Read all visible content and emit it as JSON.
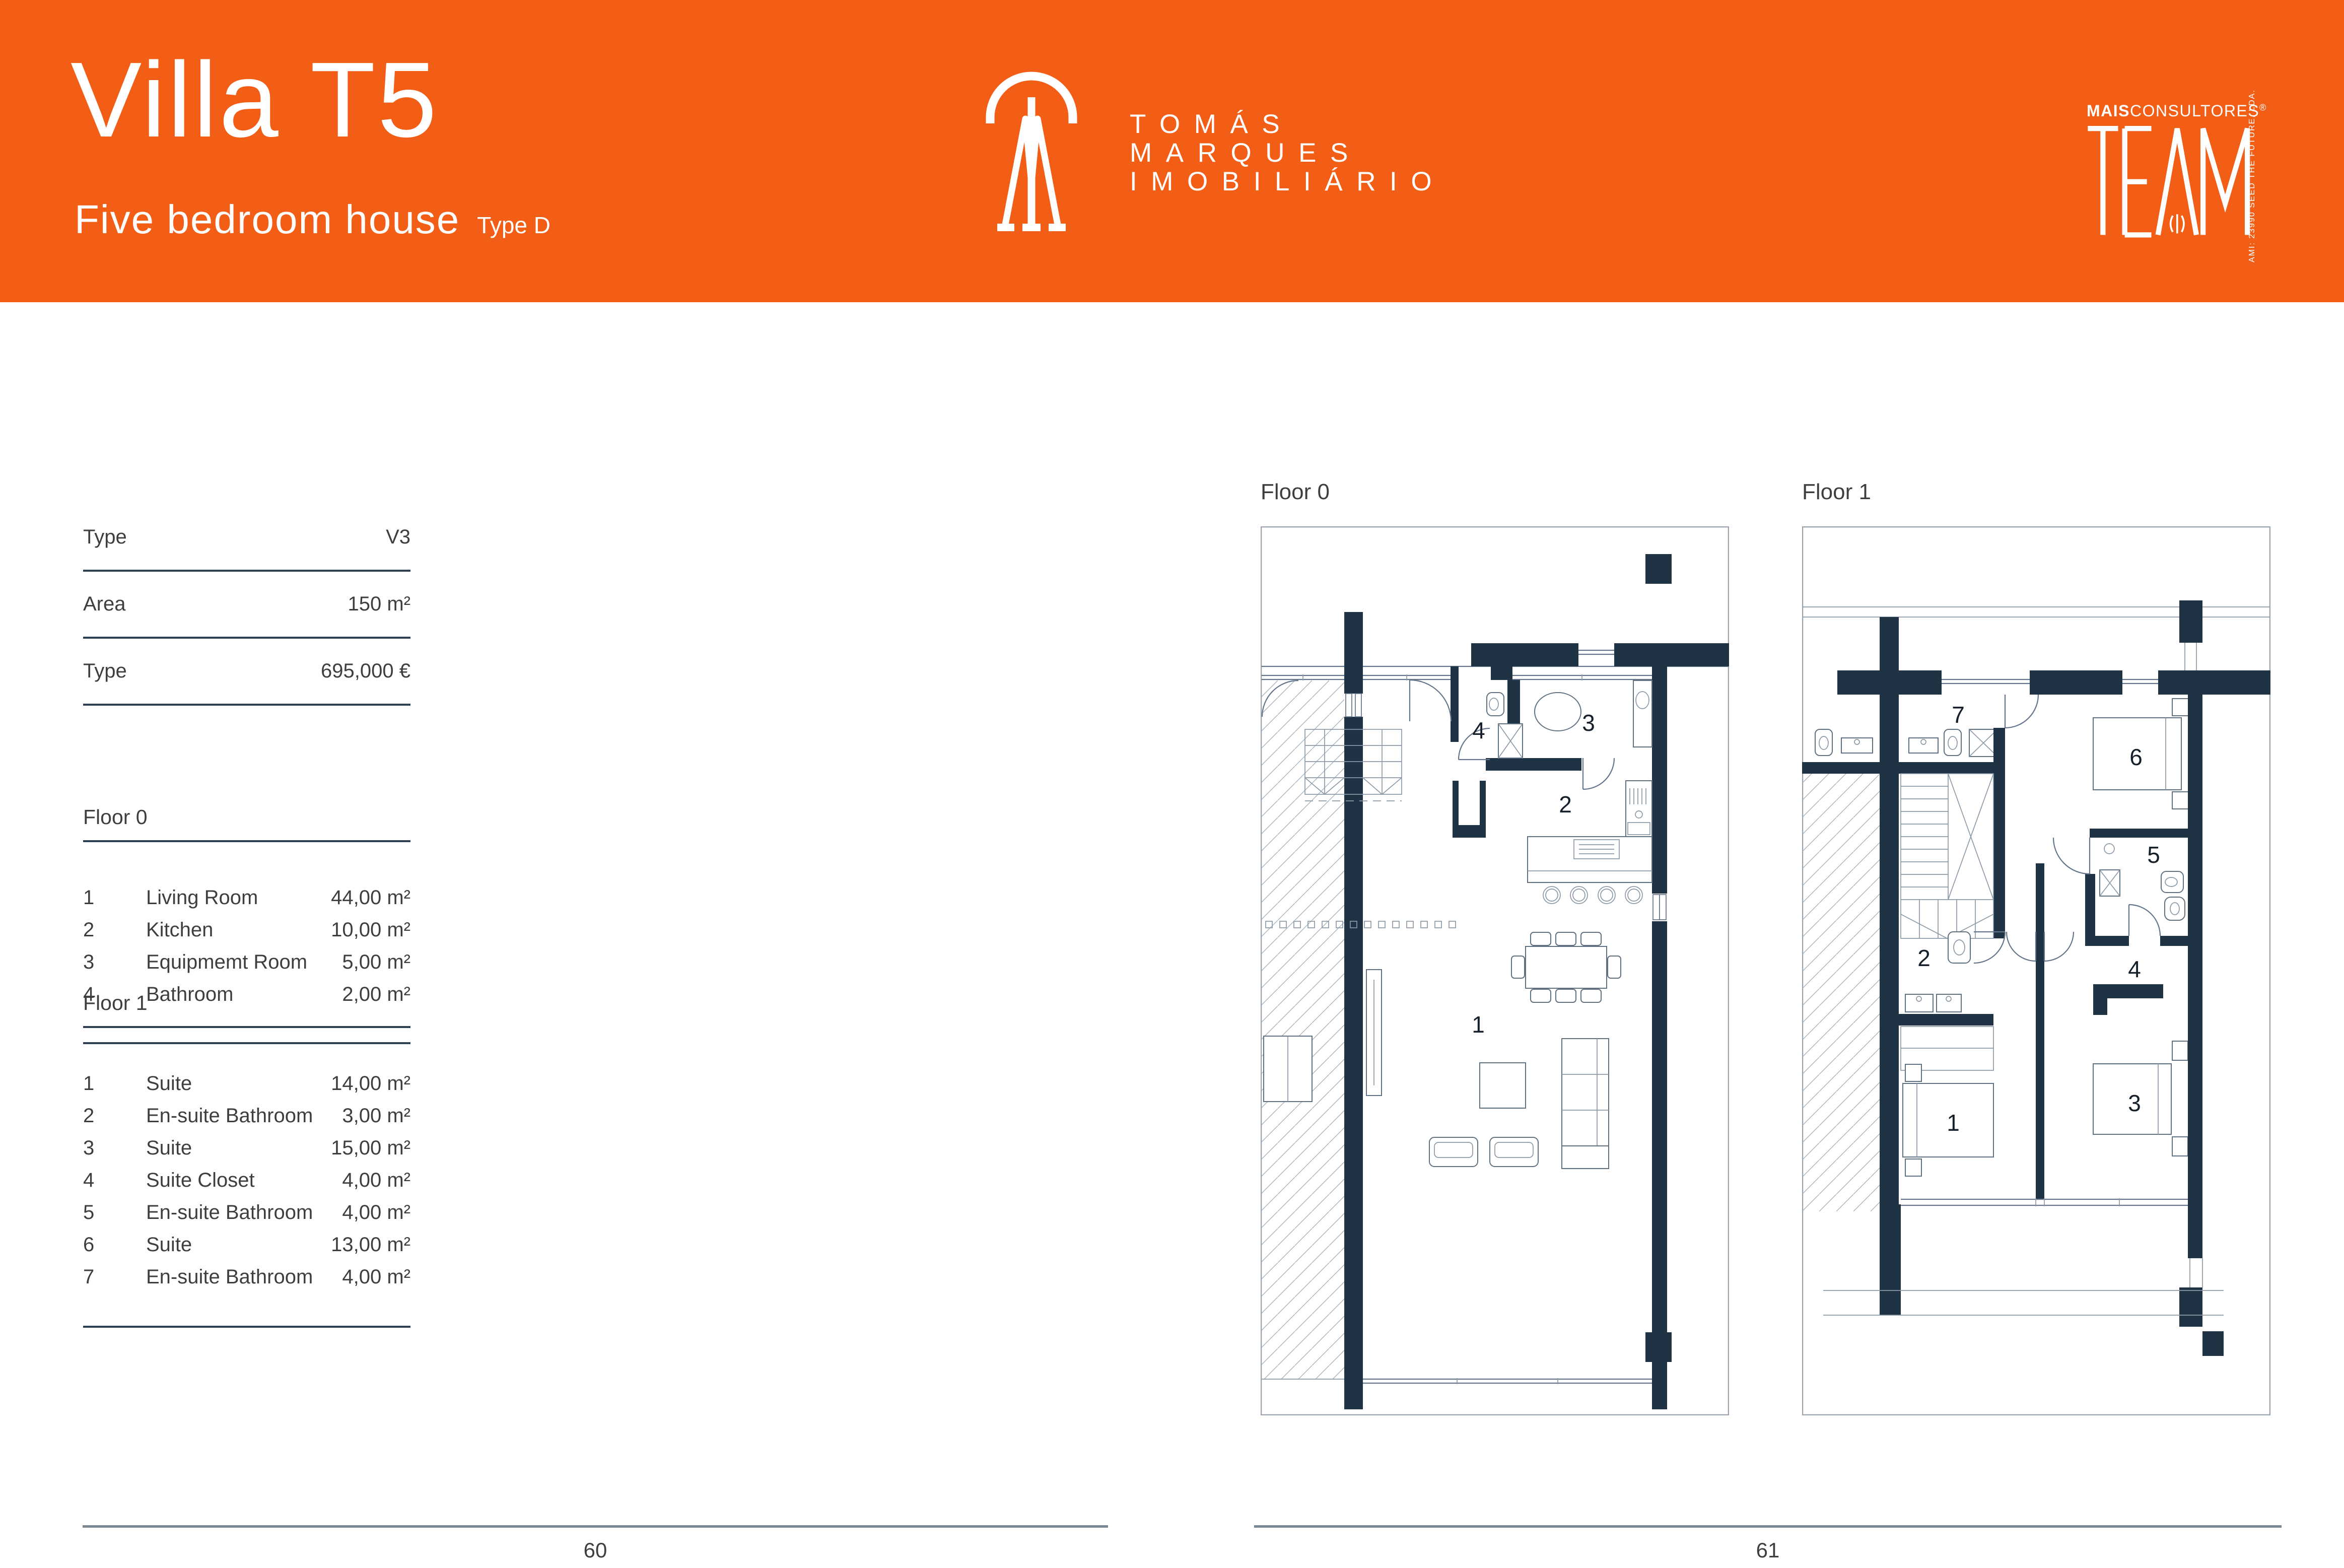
{
  "header": {
    "title": "Villa T5",
    "subtitle": "Five bedroom house",
    "type_tag": "Type D",
    "accent_color": "#F35E17",
    "brand": {
      "line1": "TOMÁS",
      "line2": "MARQUES",
      "line3": "IMOBILIÁRIO",
      "monogram": "TM-monogram-icon"
    },
    "partner": {
      "name_bold": "MAIS",
      "name_rest": "CONSULTORES",
      "reg_mark": "®",
      "wordmark": "TEAM",
      "side_text": "AMI: 23990  SEED THE FUTURE, LDA."
    }
  },
  "specs": {
    "rows": [
      {
        "label": "Type",
        "value": "V3"
      },
      {
        "label": "Area",
        "value": "150 m²"
      },
      {
        "label": "Type",
        "value": "695,000 €"
      }
    ]
  },
  "floor0": {
    "title": "Floor 0",
    "rows": [
      {
        "no": "1",
        "name": "Living Room",
        "area": "44,00 m²"
      },
      {
        "no": "2",
        "name": "Kitchen",
        "area": "10,00 m²"
      },
      {
        "no": "3",
        "name": "Equipmemt Room",
        "area": "5,00 m²"
      },
      {
        "no": "4",
        "name": "Bathroom",
        "area": "2,00 m²"
      }
    ]
  },
  "floor1": {
    "title": "Floor 1",
    "rows": [
      {
        "no": "1",
        "name": "Suite",
        "area": "14,00 m²"
      },
      {
        "no": "2",
        "name": "En-suite Bathroom",
        "area": "3,00 m²"
      },
      {
        "no": "3",
        "name": "Suite",
        "area": "15,00 m²"
      },
      {
        "no": "4",
        "name": "Suite Closet",
        "area": "4,00 m²"
      },
      {
        "no": "5",
        "name": "En-suite Bathroom",
        "area": "4,00 m²"
      },
      {
        "no": "6",
        "name": "Suite",
        "area": "13,00 m²"
      },
      {
        "no": "7",
        "name": "En-suite Bathroom",
        "area": "4,00 m²"
      }
    ]
  },
  "plans": {
    "floor0_label": "Floor 0",
    "floor1_label": "Floor 1",
    "floor0_rooms": [
      "1",
      "2",
      "3",
      "4"
    ],
    "floor1_rooms": [
      "1",
      "2",
      "3",
      "4",
      "5",
      "6",
      "7"
    ],
    "wall_color": "#1F3344"
  },
  "footer": {
    "left_page": "60",
    "right_page": "61",
    "rule_color": "#7A8894"
  }
}
